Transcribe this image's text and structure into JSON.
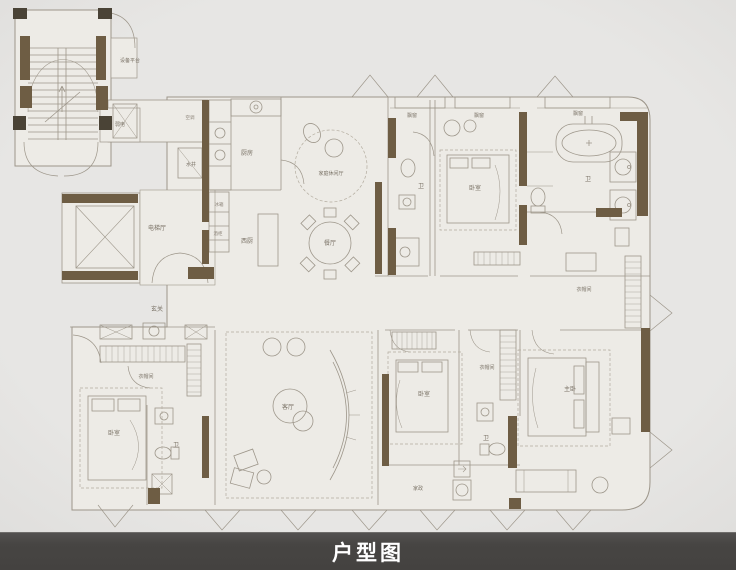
{
  "title_bar": {
    "label": "户型图"
  },
  "rooms": {
    "equipment_platform": "设备平台",
    "weak_electric": "弱电",
    "ac_platform": "空调",
    "water_shaft": "水井",
    "kitchen": "厨房",
    "family_lounge": "家庭休闲厅",
    "west_kitchen": "西厨",
    "dining_room": "餐厅",
    "elevator_hall": "电梯厅",
    "bay_window": "飘窗",
    "bath": "卫",
    "bedroom": "卧室",
    "master_bedroom": "主卧",
    "cloakroom": "衣帽间",
    "entry": "玄关",
    "living_room": "客厅",
    "housekeeping": "家政",
    "fridge": "冰箱",
    "wine_cabinet": "酒柜"
  },
  "colors": {
    "wall": "#6e5d44",
    "wall_dark": "#4a4336",
    "line": "#9d968a",
    "dashed": "#b3ac9f",
    "paper": "#edebe6",
    "background": "#d9d8d6",
    "bar_background": "#474543",
    "bar_text": "#ffffff"
  }
}
